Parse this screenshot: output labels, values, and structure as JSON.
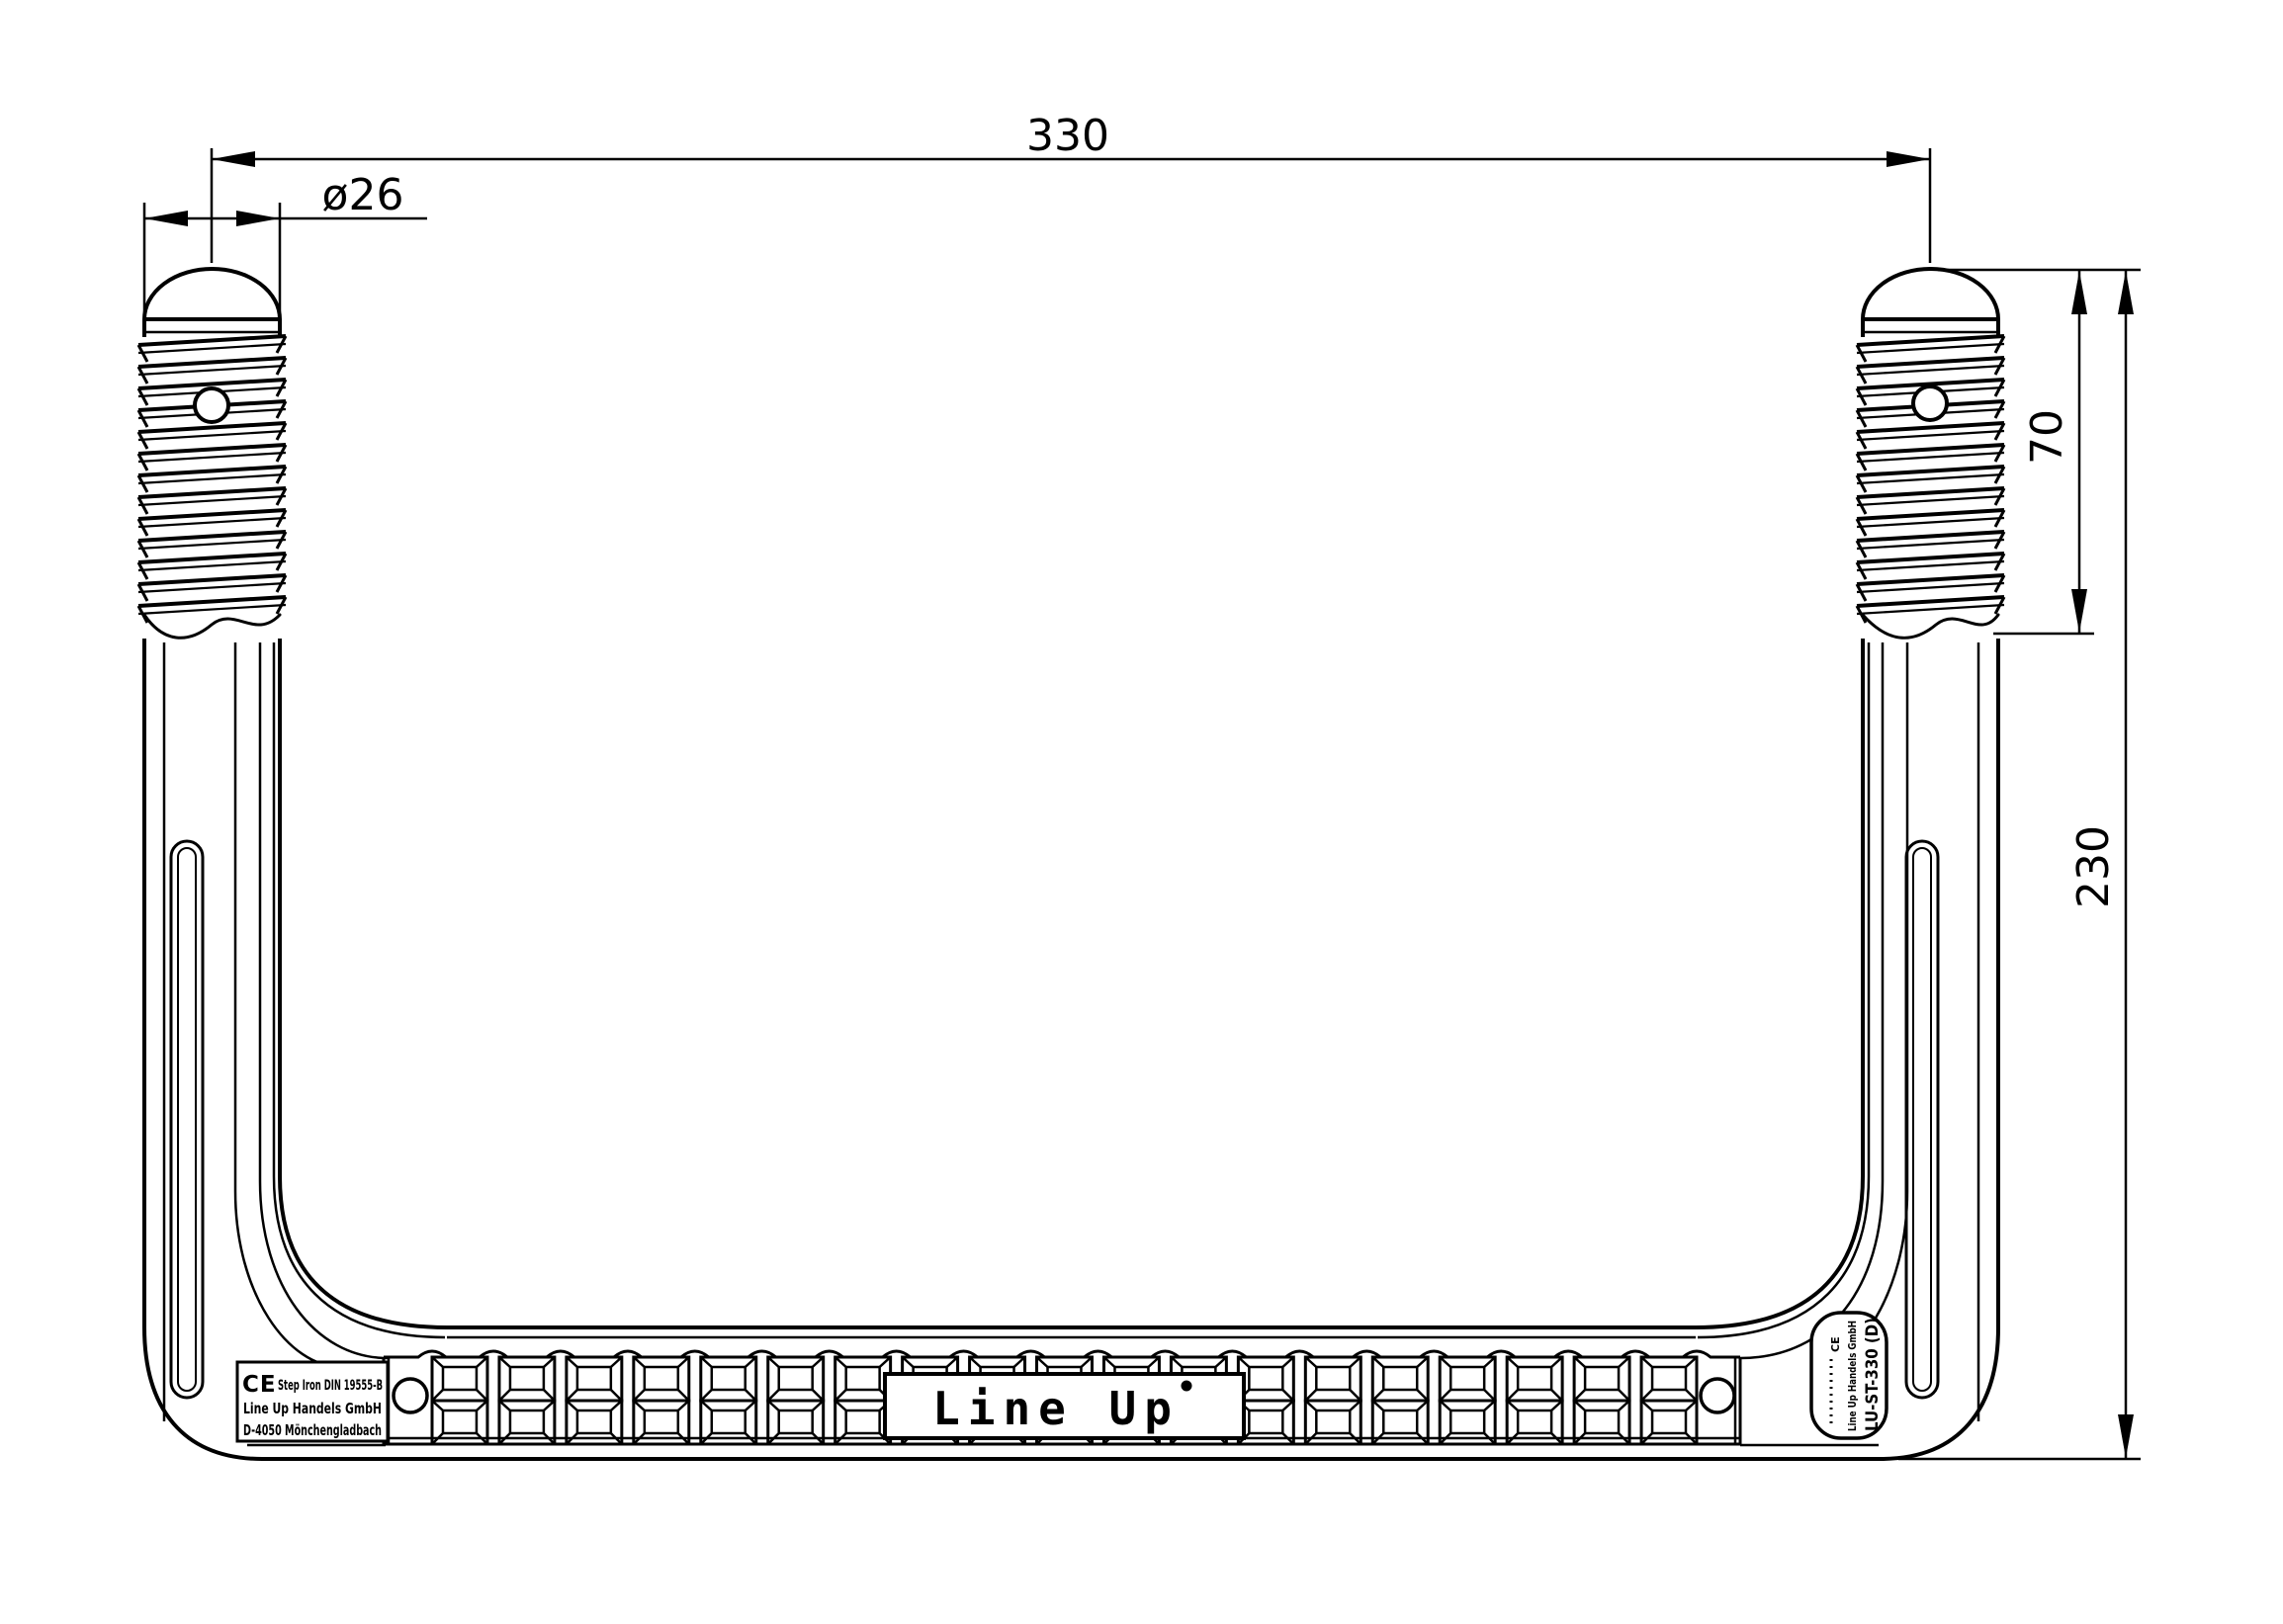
{
  "title": "Line Up step iron technical drawing",
  "dimensions": {
    "width": "330",
    "diameter": "ø26",
    "thread_length": "70",
    "height": "230"
  },
  "branding": {
    "center_text": "Line Up"
  },
  "ce_label": {
    "ce_mark": "CE",
    "line1": "Step Iron DIN 19555-B",
    "line2": "Line Up Handels GmbH",
    "line3": "D-4050 Mönchengladbach"
  },
  "side_label": {
    "ce_mark": "CE",
    "small_text": "Line Up Handels GmbH",
    "large_text": "LU-ST-330 (D)"
  },
  "threads": {
    "ridges": 13,
    "pitch": 22
  },
  "tread": {
    "columns": 19,
    "rows": 2
  },
  "colors": {
    "line": "#000000",
    "background": "#ffffff"
  }
}
